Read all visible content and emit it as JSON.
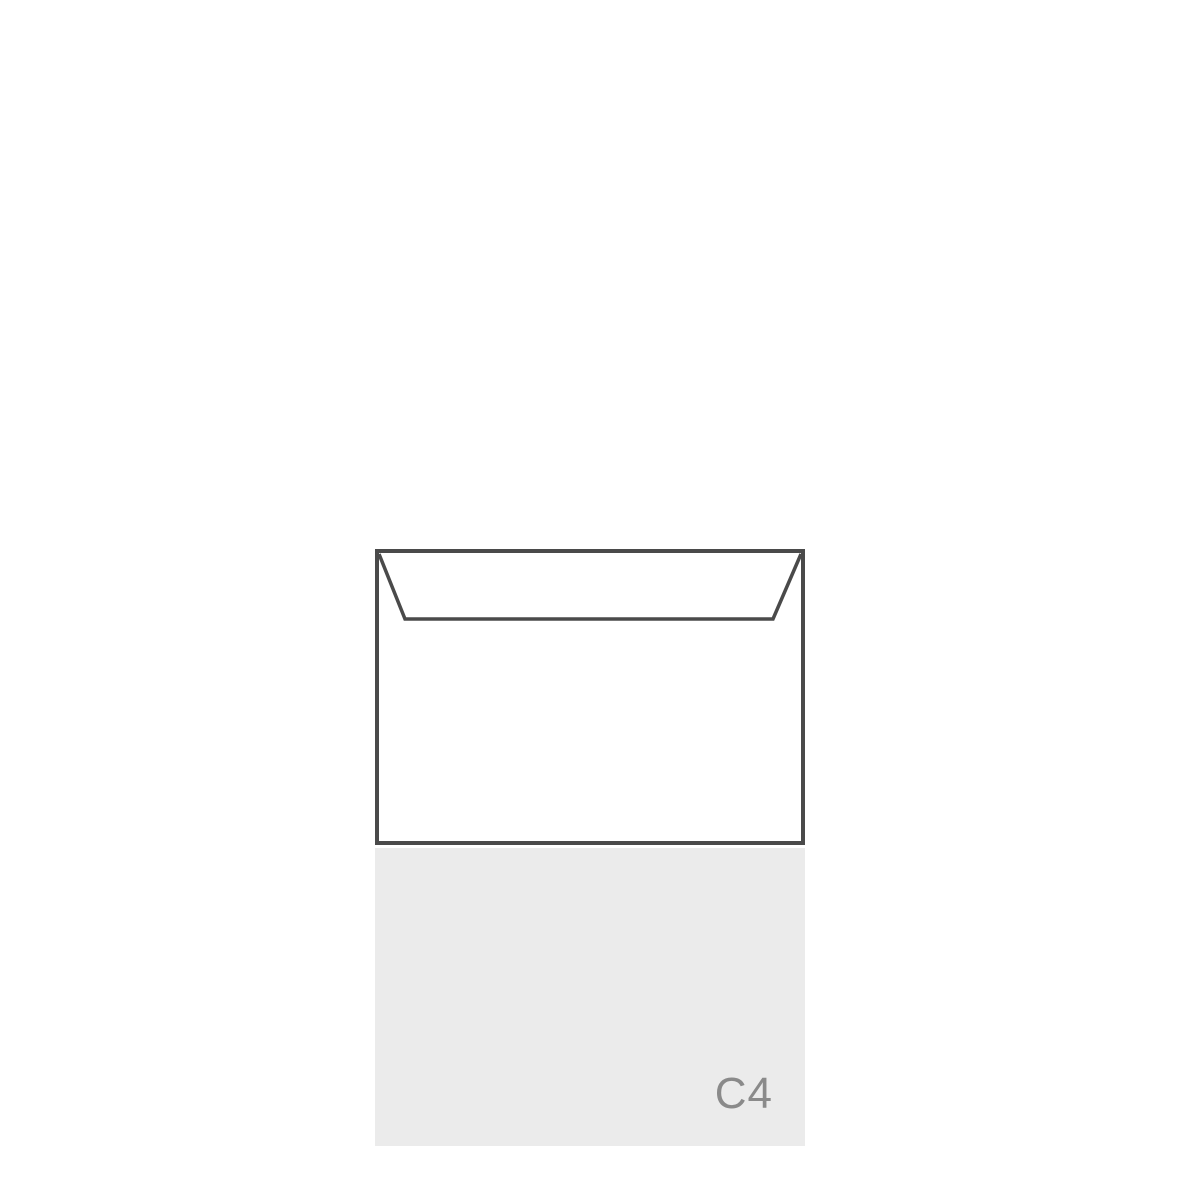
{
  "illustration": {
    "label": "C4",
    "colors": {
      "outline": "#4a4a4a",
      "sheet_bg": "#ebebeb",
      "label_text": "#8a8a8a",
      "envelope_fill": "#ffffff",
      "background": "#ffffff"
    }
  }
}
